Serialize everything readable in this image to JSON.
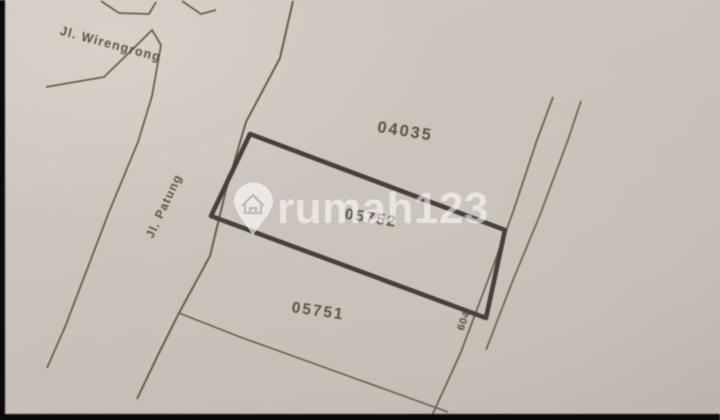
{
  "watermark": {
    "brand": "rumah123",
    "icon": "map-pin-house-icon"
  },
  "streets": [
    {
      "id": "wirengrong",
      "name": "Jl. Wirengrong"
    },
    {
      "id": "patung",
      "name": "Jl. Patung"
    },
    {
      "id": "road-604",
      "name": "604"
    }
  ],
  "parcels": [
    {
      "number": "04035"
    },
    {
      "number": "05752"
    },
    {
      "number": "05751"
    }
  ],
  "colors": {
    "paper": "#cbc3bb",
    "line": "#645c52",
    "parcel_outline_bold": "#443e37",
    "label_text": "#5b5349",
    "watermark": "#ffffff"
  }
}
